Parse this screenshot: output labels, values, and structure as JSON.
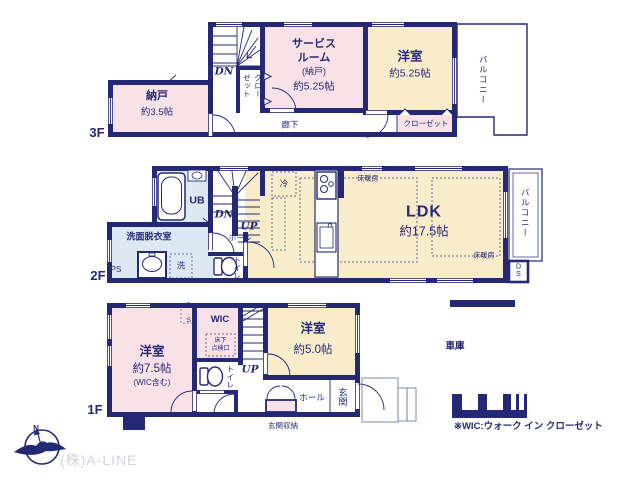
{
  "colors": {
    "wall_navy": "#252875",
    "room_pink": "#f8e1e7",
    "room_cream": "#f9ecca",
    "room_blue": "#dce9f4",
    "dotted_line": "#6b6d9b",
    "company_gray": "#d4d4dd"
  },
  "floor3": {
    "floor_label": "3F",
    "nando": {
      "name": "納戸",
      "size": "約3.5帖"
    },
    "service_room": {
      "line1": "サービス",
      "line2": "ルーム",
      "line3": "(納戸)",
      "size": "約5.25帖"
    },
    "bedroom": {
      "name": "洋室",
      "size": "約5.25帖"
    },
    "closet": "クローゼット",
    "hallway": "廊下",
    "balcony": "バルコニー",
    "dn": "DN"
  },
  "floor2": {
    "floor_label": "2F",
    "ub": "UB",
    "washroom": "洗面脱衣室",
    "ps": "PS",
    "laundry": "洗",
    "toilet": "トイレ",
    "dn": "DN",
    "up": "UP",
    "hall": "ホール",
    "fridge": "冷",
    "ldk": {
      "name": "LDK",
      "size": "約17.5帖"
    },
    "floor_heating": "床暖房",
    "balcony": "バルコニー",
    "ds": "DS"
  },
  "floor1": {
    "floor_label": "1F",
    "bedroom_main": {
      "name": "洋室",
      "size": "約7.5帖",
      "note": "(WIC含む)"
    },
    "ps": "P.S",
    "wic": "WIC",
    "inspection": {
      "line1": "床下",
      "line2": "点検口"
    },
    "up": "UP",
    "toilet": "トイレ",
    "bedroom_sub": {
      "name": "洋室",
      "size": "約5.0帖"
    },
    "hall": "ホール",
    "entrance": "玄関",
    "entrance_storage": "玄関収納",
    "garage": "車庫",
    "wic_note": "※WIC:ウォーク イン クローゼット"
  },
  "footer": {
    "compass_n": "N",
    "company": "(株)A-LINE"
  }
}
